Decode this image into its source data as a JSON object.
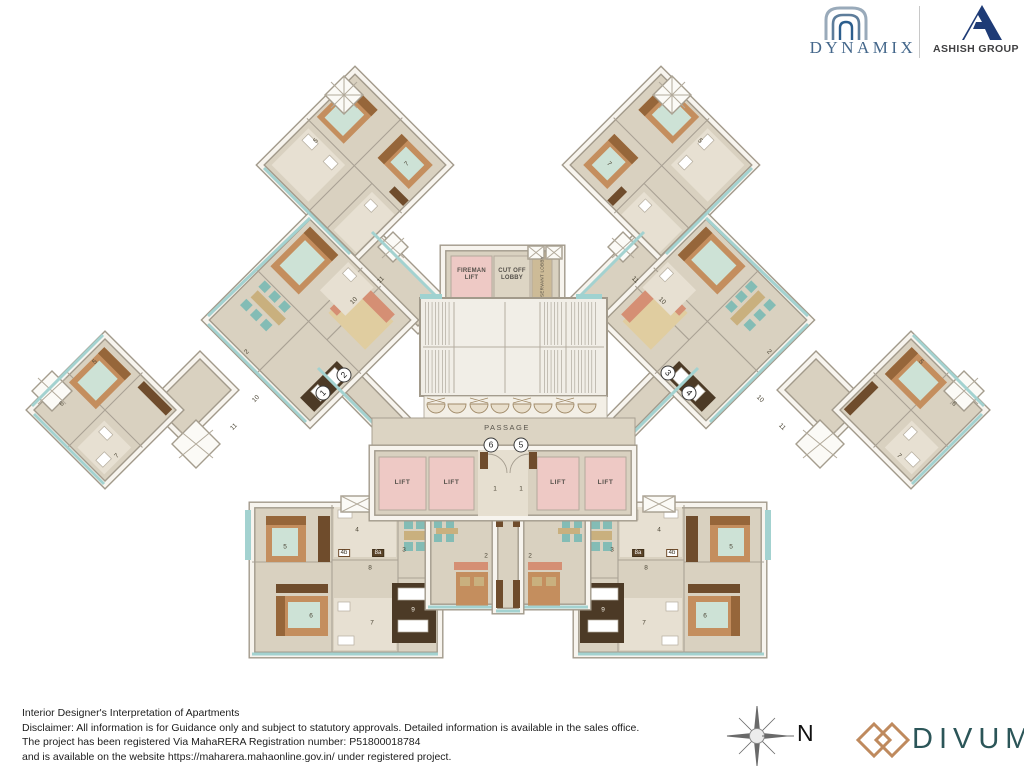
{
  "header": {
    "dynamix": "DYNAMIX",
    "ashish_group": "ASHISH GROUP"
  },
  "plan": {
    "labels": {
      "fireman_lift": "FIREMAN LIFT",
      "cut_off_lobby": "CUT OFF LOBBY",
      "servant_lobby": "SERVANT LOBBY",
      "passage": "PASSAGE"
    },
    "lifts": [
      "LIFT",
      "LIFT",
      "LIFT",
      "LIFT"
    ],
    "entry_markers": [
      {
        "n": "1",
        "x": 323,
        "y": 393,
        "r": -45
      },
      {
        "n": "2",
        "x": 344,
        "y": 375,
        "r": -45
      },
      {
        "n": "3",
        "x": 668,
        "y": 373,
        "r": 45
      },
      {
        "n": "4",
        "x": 689,
        "y": 393,
        "r": 45
      },
      {
        "n": "5",
        "x": 521,
        "y": 445,
        "r": 0
      },
      {
        "n": "6",
        "x": 491,
        "y": 445,
        "r": 0
      }
    ],
    "room_labels": [
      {
        "t": "5",
        "x": 285,
        "y": 547
      },
      {
        "t": "4",
        "x": 357,
        "y": 530
      },
      {
        "t": "4b",
        "x": 344,
        "y": 553,
        "s": "box"
      },
      {
        "t": "8a",
        "x": 378,
        "y": 553,
        "s": "dark"
      },
      {
        "t": "3",
        "x": 404,
        "y": 550
      },
      {
        "t": "8",
        "x": 370,
        "y": 568
      },
      {
        "t": "6",
        "x": 311,
        "y": 616
      },
      {
        "t": "7",
        "x": 372,
        "y": 623
      },
      {
        "t": "9",
        "x": 413,
        "y": 610,
        "s": "light"
      },
      {
        "t": "5",
        "x": 731,
        "y": 547
      },
      {
        "t": "4",
        "x": 659,
        "y": 530
      },
      {
        "t": "4b",
        "x": 672,
        "y": 553,
        "s": "box"
      },
      {
        "t": "8a",
        "x": 638,
        "y": 553,
        "s": "dark"
      },
      {
        "t": "3",
        "x": 612,
        "y": 550
      },
      {
        "t": "8",
        "x": 646,
        "y": 568
      },
      {
        "t": "6",
        "x": 705,
        "y": 616
      },
      {
        "t": "7",
        "x": 644,
        "y": 623
      },
      {
        "t": "9",
        "x": 603,
        "y": 610,
        "s": "light"
      },
      {
        "t": "2",
        "x": 486,
        "y": 556
      },
      {
        "t": "2",
        "x": 530,
        "y": 556
      },
      {
        "t": "1",
        "x": 495,
        "y": 489
      },
      {
        "t": "1",
        "x": 521,
        "y": 489
      },
      {
        "t": "5",
        "x": 316,
        "y": 141,
        "r": -45
      },
      {
        "t": "7",
        "x": 407,
        "y": 164,
        "r": -45
      },
      {
        "t": "5",
        "x": 700,
        "y": 141,
        "r": 45
      },
      {
        "t": "7",
        "x": 609,
        "y": 164,
        "r": 45
      },
      {
        "t": "10",
        "x": 354,
        "y": 301,
        "r": -45
      },
      {
        "t": "11",
        "x": 381,
        "y": 280,
        "r": -45
      },
      {
        "t": "10",
        "x": 662,
        "y": 301,
        "r": 45
      },
      {
        "t": "11",
        "x": 635,
        "y": 280,
        "r": 45
      },
      {
        "t": "2",
        "x": 247,
        "y": 352,
        "r": -45
      },
      {
        "t": "2",
        "x": 769,
        "y": 352,
        "r": 45
      },
      {
        "t": "10",
        "x": 256,
        "y": 399,
        "r": -45
      },
      {
        "t": "11",
        "x": 234,
        "y": 427,
        "r": -45
      },
      {
        "t": "10",
        "x": 760,
        "y": 399,
        "r": 45
      },
      {
        "t": "11",
        "x": 782,
        "y": 427,
        "r": 45
      },
      {
        "t": "5",
        "x": 95,
        "y": 362,
        "r": -45
      },
      {
        "t": "6",
        "x": 62,
        "y": 404,
        "r": -45
      },
      {
        "t": "7",
        "x": 117,
        "y": 456,
        "r": -45
      },
      {
        "t": "5",
        "x": 921,
        "y": 362,
        "r": 45
      },
      {
        "t": "6",
        "x": 954,
        "y": 404,
        "r": 45
      },
      {
        "t": "7",
        "x": 899,
        "y": 456,
        "r": 45
      }
    ]
  },
  "footer": {
    "lines": [
      "Interior Designer's Interpretation of Apartments",
      "Disclaimer: All information is for Guidance only and subject to statutory approvals. Detailed information is available in the sales office.",
      "The project has been registered Via MahaRERA Registration number:  P51800018784",
      "and is available on the website https://maharera.mahaonline.gov.in/ under registered project."
    ],
    "compass_label": "N",
    "logo_text": "DIVUM"
  },
  "colors": {
    "floor": "#d9d1c0",
    "wall_line": "#a29a8b",
    "balcony_teal": "#a3d2d0",
    "lift_pink": "#eec9c5",
    "bed_tan": "#c48e5e",
    "wood_dark": "#6f4c2c",
    "chair_teal": "#83bcb5",
    "sofa_salmon": "#d58f74",
    "brand_blue": "#44678b",
    "brand_navy": "#1e3b76",
    "brand_tan": "#bf8a5e",
    "brand_teal_dark": "#2b5558"
  }
}
